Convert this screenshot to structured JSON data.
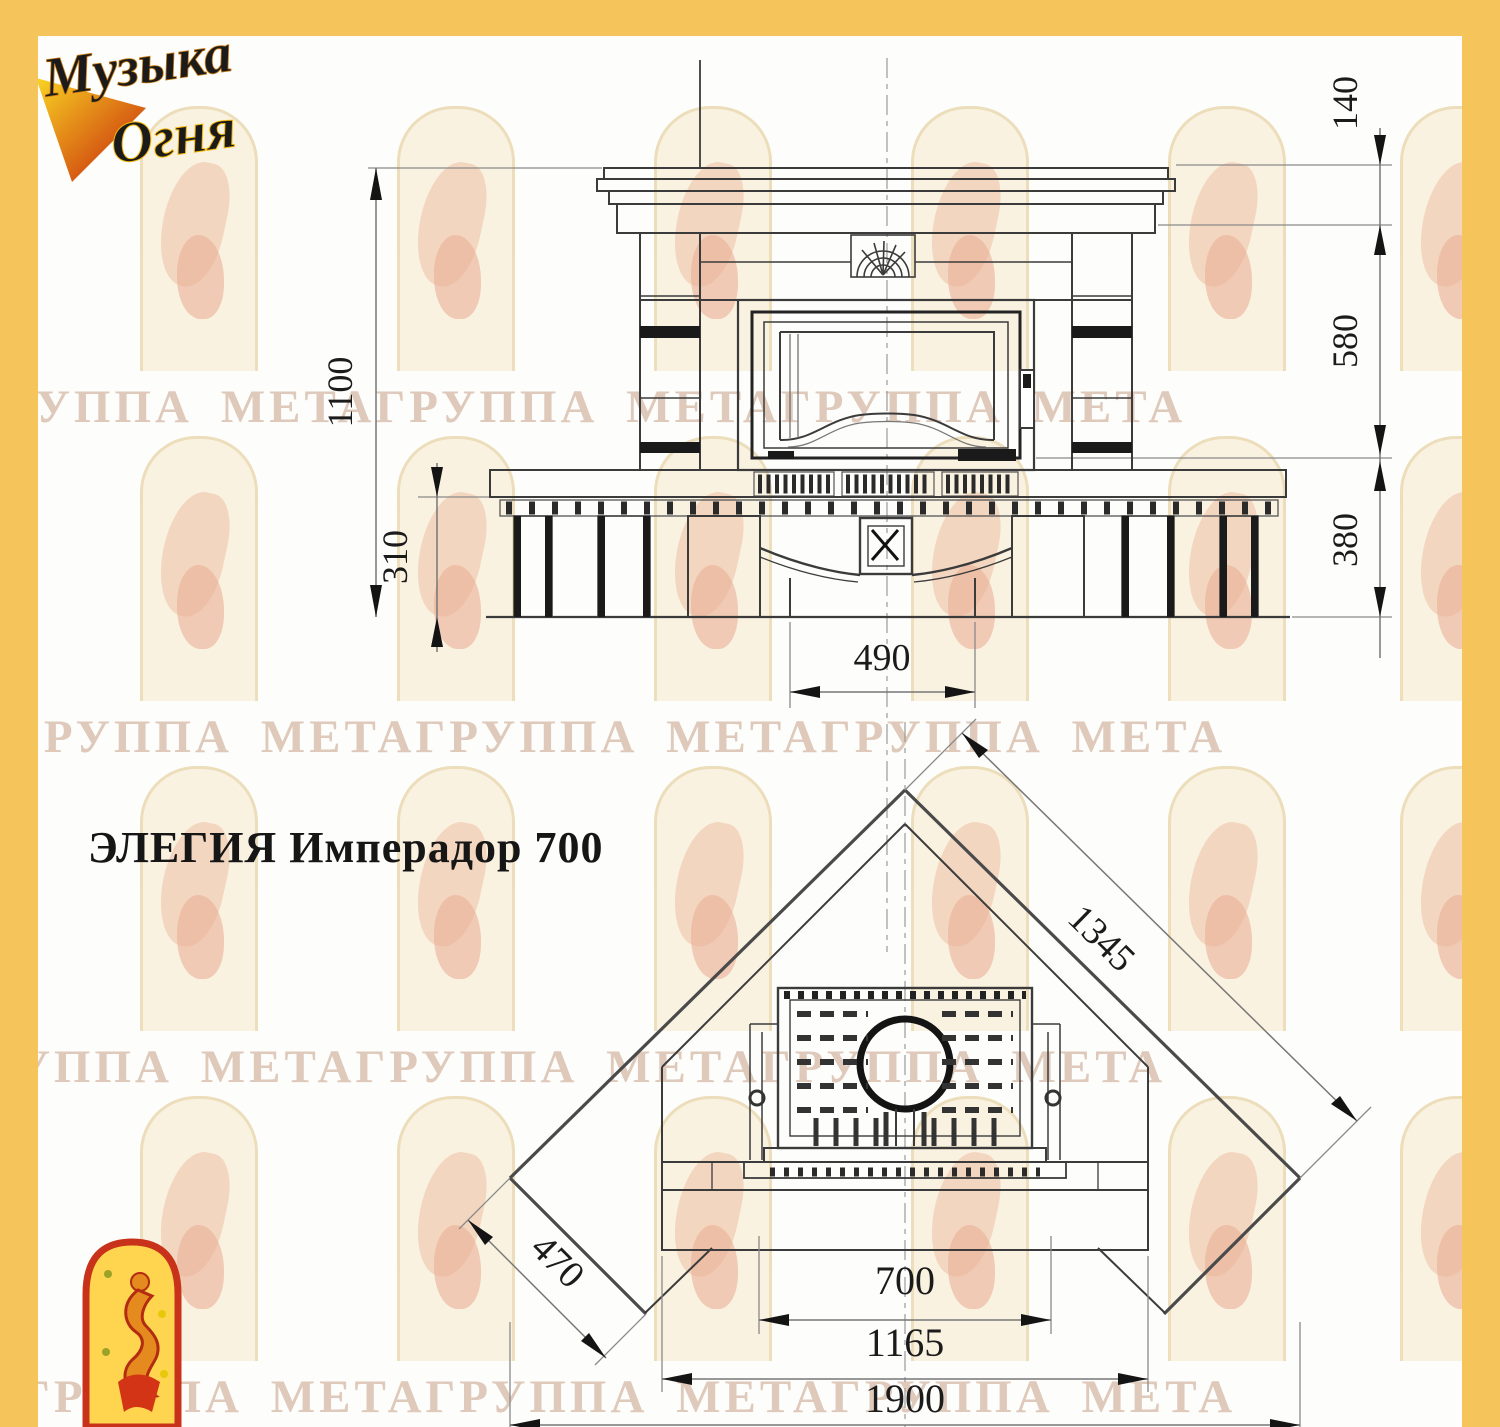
{
  "frame": {
    "color": "#F5C55C"
  },
  "logo": {
    "line1": "Музыка",
    "line2": "Огня"
  },
  "title": "ЭЛЕГИЯ Имперадор 700",
  "watermark": {
    "text": "ГРУППА МЕТАГРУППА МЕТАГРУППА МЕТА"
  },
  "front_view": {
    "dim_height_total": "1100",
    "dim_bench_height": "310",
    "dim_crown": "140",
    "dim_body": "580",
    "dim_base": "380",
    "dim_pedestal": "490"
  },
  "plan_view": {
    "dim_diagonal": "1345",
    "dim_side_return": "470",
    "dim_firebox": "700",
    "dim_hearth": "1165",
    "dim_total_width": "1900"
  }
}
